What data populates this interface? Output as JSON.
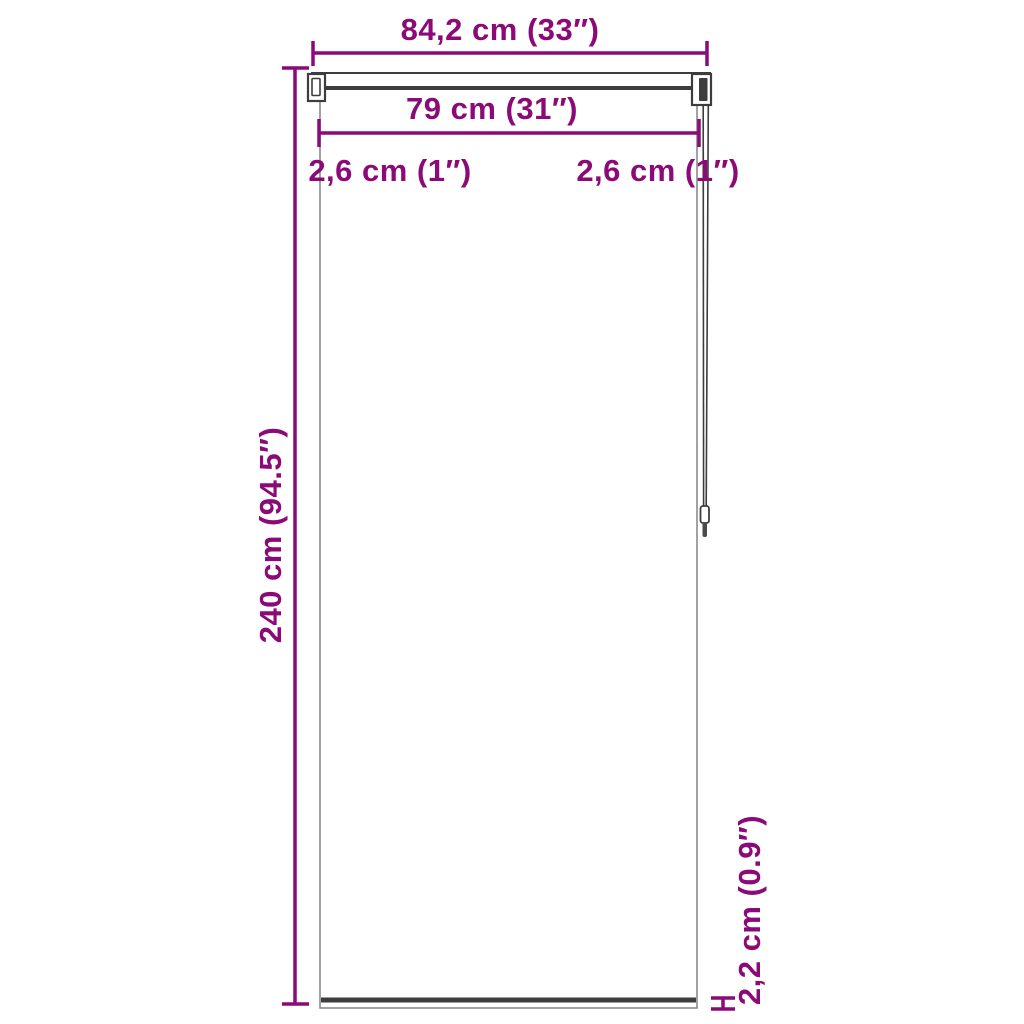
{
  "diagram": {
    "title": "roller-blind-dimension-diagram",
    "labels": {
      "total_width": "84,2 cm (33″)",
      "fabric_width": "79 cm (31″)",
      "left_margin": "2,6 cm (1″)",
      "right_margin": "2,6 cm (1″)",
      "height": "240 cm (94.5″)",
      "bottom_bar_height": "2,2 cm (0.9″)"
    }
  },
  "colors": {
    "accent": "#8B0A78",
    "outline": "#3d3d3d",
    "fabric_edge": "#8a8a8a",
    "background": "#ffffff"
  }
}
